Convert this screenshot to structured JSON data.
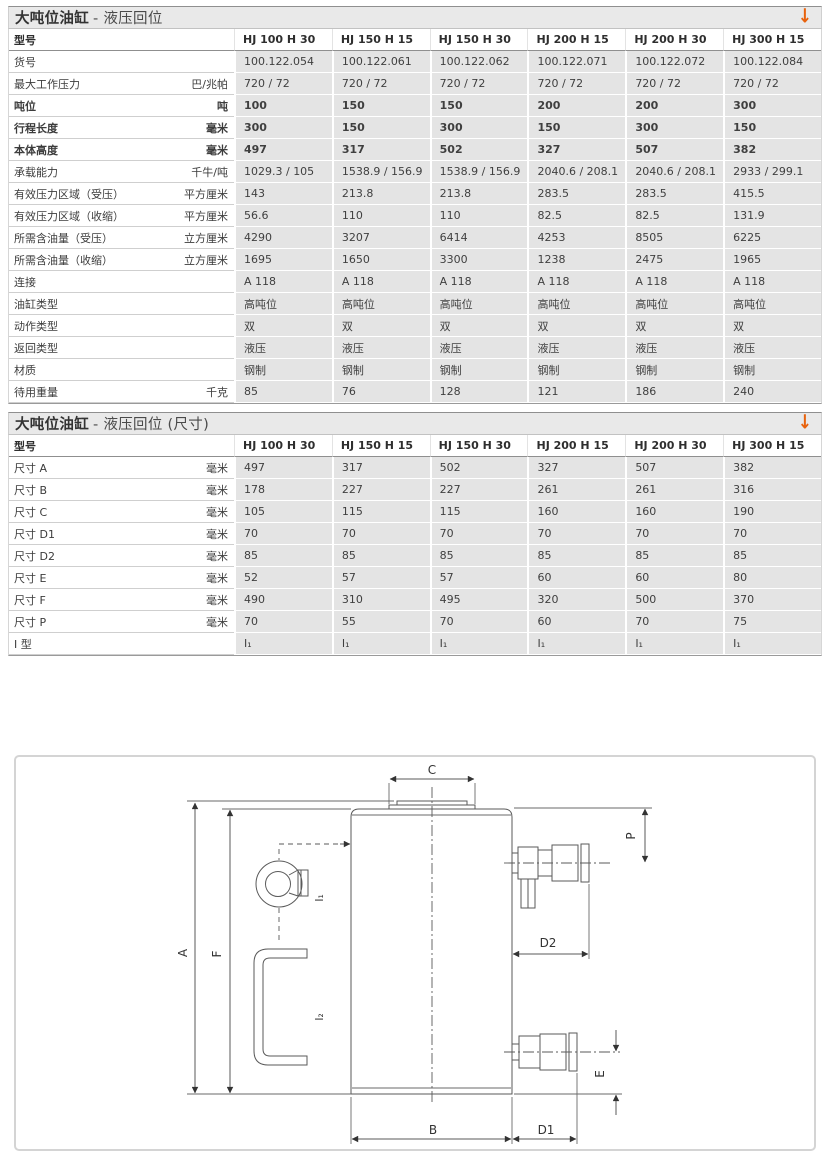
{
  "colors": {
    "accent_orange": "#e8620d",
    "title_bar_bg": "#e9e9e9",
    "data_cell_bg": "#e4e4e4",
    "header_rule": "#8f8f8f",
    "diagram_stroke": "#5a5a5a"
  },
  "tables": [
    {
      "title_main": "大吨位油缸",
      "title_sub": "- 液压回位",
      "arrow": "↓",
      "columns": [
        "型号",
        "HJ 100 H 30",
        "HJ 150 H 15",
        "HJ 150 H 30",
        "HJ 200 H 15",
        "HJ 200 H 30",
        "HJ 300 H 15"
      ],
      "rows": [
        {
          "label": "货号",
          "unit": "",
          "bold": false,
          "values": [
            "100.122.054",
            "100.122.061",
            "100.122.062",
            "100.122.071",
            "100.122.072",
            "100.122.084"
          ]
        },
        {
          "label": "最大工作压力",
          "unit": "巴/兆帕",
          "bold": false,
          "values": [
            "720 / 72",
            "720 / 72",
            "720 / 72",
            "720 / 72",
            "720 / 72",
            "720 / 72"
          ]
        },
        {
          "label": "吨位",
          "unit": "吨",
          "bold": true,
          "values": [
            "100",
            "150",
            "150",
            "200",
            "200",
            "300"
          ]
        },
        {
          "label": "行程长度",
          "unit": "毫米",
          "bold": true,
          "values": [
            "300",
            "150",
            "300",
            "150",
            "300",
            "150"
          ]
        },
        {
          "label": "本体高度",
          "unit": "毫米",
          "bold": true,
          "values": [
            "497",
            "317",
            "502",
            "327",
            "507",
            "382"
          ]
        },
        {
          "label": "承载能力",
          "unit": "千牛/吨",
          "bold": false,
          "values": [
            "1029.3 / 105",
            "1538.9 / 156.9",
            "1538.9 / 156.9",
            "2040.6 / 208.1",
            "2040.6 / 208.1",
            "2933 / 299.1"
          ]
        },
        {
          "label": "有效压力区域（受压）",
          "unit": "平方厘米",
          "bold": false,
          "values": [
            "143",
            "213.8",
            "213.8",
            "283.5",
            "283.5",
            "415.5"
          ]
        },
        {
          "label": "有效压力区域（收缩）",
          "unit": "平方厘米",
          "bold": false,
          "values": [
            "56.6",
            "110",
            "110",
            "82.5",
            "82.5",
            "131.9"
          ]
        },
        {
          "label": "所需含油量（受压）",
          "unit": "立方厘米",
          "bold": false,
          "values": [
            "4290",
            "3207",
            "6414",
            "4253",
            "8505",
            "6225"
          ]
        },
        {
          "label": "所需含油量（收缩）",
          "unit": "立方厘米",
          "bold": false,
          "values": [
            "1695",
            "1650",
            "3300",
            "1238",
            "2475",
            "1965"
          ]
        },
        {
          "label": "连接",
          "unit": "",
          "bold": false,
          "values": [
            "A 118",
            "A 118",
            "A 118",
            "A 118",
            "A 118",
            "A 118"
          ]
        },
        {
          "label": "油缸类型",
          "unit": "",
          "bold": false,
          "values": [
            "高吨位",
            "高吨位",
            "高吨位",
            "高吨位",
            "高吨位",
            "高吨位"
          ]
        },
        {
          "label": "动作类型",
          "unit": "",
          "bold": false,
          "values": [
            "双",
            "双",
            "双",
            "双",
            "双",
            "双"
          ]
        },
        {
          "label": "返回类型",
          "unit": "",
          "bold": false,
          "values": [
            "液压",
            "液压",
            "液压",
            "液压",
            "液压",
            "液压"
          ]
        },
        {
          "label": "材质",
          "unit": "",
          "bold": false,
          "values": [
            "钢制",
            "钢制",
            "钢制",
            "钢制",
            "钢制",
            "钢制"
          ]
        },
        {
          "label": "待用重量",
          "unit": "千克",
          "bold": false,
          "values": [
            "85",
            "76",
            "128",
            "121",
            "186",
            "240"
          ]
        }
      ]
    },
    {
      "title_main": "大吨位油缸",
      "title_sub": "- 液压回位 (尺寸)",
      "arrow": "↓",
      "columns": [
        "型号",
        "HJ 100 H 30",
        "HJ 150 H 15",
        "HJ 150 H 30",
        "HJ 200 H 15",
        "HJ 200 H 30",
        "HJ 300 H 15"
      ],
      "rows": [
        {
          "label": "尺寸 A",
          "unit": "毫米",
          "bold": false,
          "values": [
            "497",
            "317",
            "502",
            "327",
            "507",
            "382"
          ]
        },
        {
          "label": "尺寸 B",
          "unit": "毫米",
          "bold": false,
          "values": [
            "178",
            "227",
            "227",
            "261",
            "261",
            "316"
          ]
        },
        {
          "label": "尺寸 C",
          "unit": "毫米",
          "bold": false,
          "values": [
            "105",
            "115",
            "115",
            "160",
            "160",
            "190"
          ]
        },
        {
          "label": "尺寸 D1",
          "unit": "毫米",
          "bold": false,
          "values": [
            "70",
            "70",
            "70",
            "70",
            "70",
            "70"
          ]
        },
        {
          "label": "尺寸 D2",
          "unit": "毫米",
          "bold": false,
          "values": [
            "85",
            "85",
            "85",
            "85",
            "85",
            "85"
          ]
        },
        {
          "label": "尺寸 E",
          "unit": "毫米",
          "bold": false,
          "values": [
            "52",
            "57",
            "57",
            "60",
            "60",
            "80"
          ]
        },
        {
          "label": "尺寸 F",
          "unit": "毫米",
          "bold": false,
          "values": [
            "490",
            "310",
            "495",
            "320",
            "500",
            "370"
          ]
        },
        {
          "label": "尺寸 P",
          "unit": "毫米",
          "bold": false,
          "values": [
            "70",
            "55",
            "70",
            "60",
            "70",
            "75"
          ]
        },
        {
          "label": "I 型",
          "unit": "",
          "bold": false,
          "values": [
            "I₁",
            "I₁",
            "I₁",
            "I₁",
            "I₁",
            "I₁"
          ]
        }
      ]
    }
  ],
  "diagram": {
    "labels": {
      "A": "A",
      "F": "F",
      "C": "C",
      "P": "P",
      "D2": "D2",
      "E": "E",
      "B": "B",
      "D1": "D1",
      "I1": "I₁",
      "I2": "I₂"
    }
  }
}
